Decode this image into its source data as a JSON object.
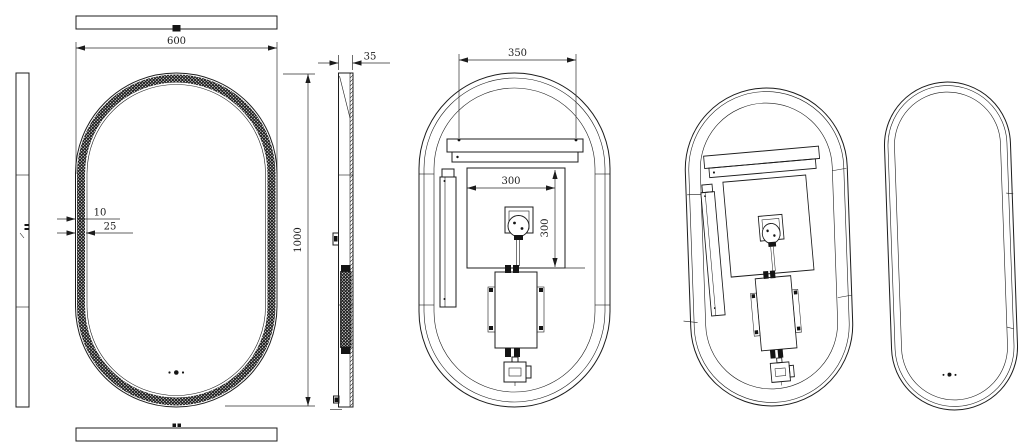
{
  "drawing": {
    "background_color": "#ffffff",
    "line_color": "#1c1c1c",
    "dims": {
      "overall_width": "600",
      "overall_height": "1000",
      "depth": "35",
      "frame_lip": "10",
      "led_band": "25",
      "hanger_bar_width": "350",
      "backplate_width": "300",
      "backplate_height": "300"
    }
  }
}
